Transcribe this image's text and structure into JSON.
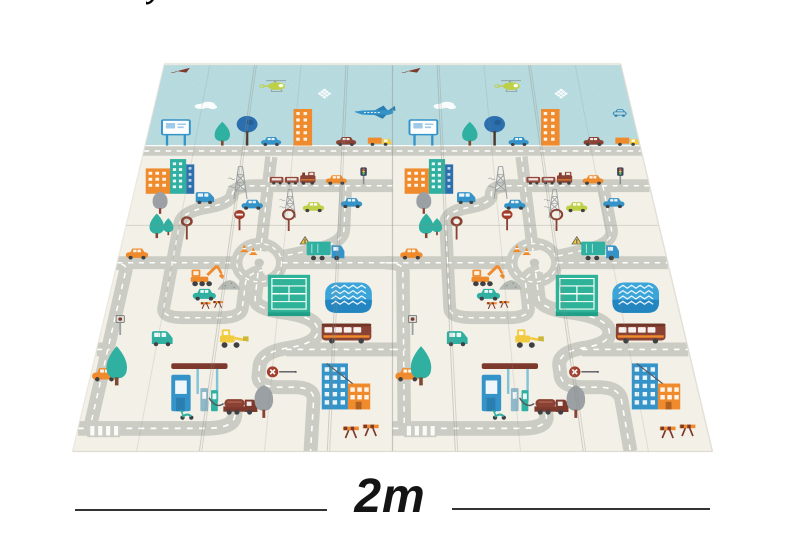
{
  "image_type": "product-photo of foldable baby play mat with road map print",
  "annotation": {
    "label": "2m",
    "y": 510,
    "lines": [
      [
        75,
        327
      ],
      [
        452,
        710
      ]
    ]
  },
  "cropped_text_fragment": "y",
  "palette": {
    "cream": "#f3f0e7",
    "skyBlue": "#b6dade",
    "roadGray": "#cbccc3",
    "roadDash": "#ffffff",
    "teal": "#2fb0a0",
    "courtGreen": "#2eb398",
    "courtDark": "#1f9e88",
    "blue": "#3493c8",
    "blueDark": "#2a7fb0",
    "pondBlue": "#3ba4d9",
    "pondDark": "#2386c0",
    "navy": "#2b6fae",
    "maroon": "#8a4234",
    "darkRed": "#7d392c",
    "orange": "#ef8b2d",
    "yellow": "#f2ca3f",
    "yellowGreen": "#bed048",
    "gray": "#9aa0a3",
    "slate": "#55565a",
    "wheel": "#3f4043",
    "trunk": "#7c4a33",
    "black": "#1b1b1b",
    "edge": "#e4e1d8",
    "crease": "#8f9089",
    "windowWhite": "#ffffff"
  },
  "mat": {
    "projection": {
      "P": 2339,
      "sin": 0.866,
      "flatW": 640,
      "flatH": 1087,
      "centerX": 392.5,
      "bottomY": 451.5
    },
    "skyBand": {
      "top": 0,
      "bottom": 295
    },
    "skyRoad": {
      "top": 295,
      "bottom": 333
    },
    "halves": [
      0,
      320
    ],
    "creases": [
      {
        "x": 64,
        "w": "light"
      },
      {
        "x": 128,
        "w": "strong"
      },
      {
        "x": 192,
        "w": "light"
      },
      {
        "x": 256,
        "w": "strong"
      },
      {
        "x": 320,
        "w": "seam"
      },
      {
        "x": 384,
        "w": "strong"
      },
      {
        "x": 448,
        "w": "light"
      },
      {
        "x": 512,
        "w": "strong"
      },
      {
        "x": 576,
        "w": "light"
      }
    ],
    "hCrease": 544
  },
  "roads": {
    "width": 15,
    "paths": [
      [
        "M",
        165,
        333,
        "V",
        616
      ],
      [
        "M",
        320,
        425,
        "H",
        150,
        "Q",
        122,
        425,
        122,
        452,
        "Q",
        122,
        478,
        96,
        490,
        "Q",
        64,
        502,
        64,
        540,
        "V",
        766,
        "Q",
        64,
        790,
        88,
        790,
        "H",
        128,
        "Q",
        152,
        790,
        152,
        766,
        "V",
        702,
        "Q",
        152,
        678,
        170,
        668
      ],
      [
        "M",
        262,
        425,
        "V",
        555,
        "Q",
        262,
        588,
        238,
        606,
        "Q",
        214,
        620,
        191,
        631
      ],
      [
        "M",
        0,
        648,
        "H",
        138
      ],
      [
        "M",
        192,
        648,
        "H",
        320
      ],
      [
        "M",
        165,
        675,
        "V",
        740,
        "Q",
        165,
        766,
        195,
        776,
        "Q",
        238,
        788,
        238,
        822,
        "Q",
        238,
        852,
        208,
        862,
        "Q",
        178,
        872,
        178,
        905,
        "V",
        926,
        "Q",
        178,
        952,
        202,
        952,
        "H",
        216,
        "Q",
        238,
        952,
        238,
        980,
        "V",
        1087
      ],
      [
        "M",
        0,
        1040,
        "H",
        130,
        "Q",
        158,
        1040,
        158,
        1014,
        "V",
        988
      ],
      [
        "M",
        -8,
        648,
        "Q",
        12,
        648,
        12,
        669,
        "V",
        1040
      ],
      [
        "M",
        205,
        866,
        "H",
        320
      ],
      [
        "M",
        0,
        866,
        "H",
        14
      ]
    ],
    "roundabout": {
      "x": 165,
      "y": 648,
      "r": 26
    }
  },
  "objects": [
    {
      "t": "kite",
      "x": 30,
      "y": 42
    },
    {
      "t": "heli",
      "x": 160,
      "y": 108
    },
    {
      "t": "cloud",
      "x": 70,
      "y": 170
    },
    {
      "t": "cloudDiamond",
      "x": 228,
      "y": 136
    },
    {
      "t": "plane",
      "x": 298,
      "y": 196,
      "half": 0
    },
    {
      "t": "carOutline",
      "x": 302,
      "y": 198,
      "half": 1
    },
    {
      "t": "billboard",
      "x": 40,
      "y": 296
    },
    {
      "t": "treeTeal",
      "x": 100,
      "y": 296,
      "s": 1.15
    },
    {
      "t": "treeBlue",
      "x": 132,
      "y": 296
    },
    {
      "t": "sedan",
      "x": 163,
      "y": 296,
      "c": "blue"
    },
    {
      "t": "building",
      "x": 204,
      "y": 296
    },
    {
      "t": "sedan",
      "x": 260,
      "y": 296,
      "c": "maroon"
    },
    {
      "t": "truckSmall",
      "x": 303,
      "y": 296
    },
    {
      "t": "cityblock",
      "x": 45,
      "y": 450
    },
    {
      "t": "pylon",
      "x": 133,
      "y": 466
    },
    {
      "t": "train",
      "x": 196,
      "y": 421
    },
    {
      "t": "sedan",
      "x": 250,
      "y": 421,
      "c": "orange"
    },
    {
      "t": "trafficLight",
      "x": 284,
      "y": 421
    },
    {
      "t": "treeGray",
      "x": 38,
      "y": 510
    },
    {
      "t": "van",
      "x": 90,
      "y": 480,
      "c": "blue"
    },
    {
      "t": "sedan",
      "x": 149,
      "y": 497,
      "c": "blue"
    },
    {
      "t": "pylon",
      "x": 196,
      "y": 522,
      "s": 0.85
    },
    {
      "t": "sedan",
      "x": 224,
      "y": 504,
      "c": "yellowGreen"
    },
    {
      "t": "sedan",
      "x": 270,
      "y": 492,
      "c": "blue"
    },
    {
      "t": "treeTeal",
      "x": 40,
      "y": 580
    },
    {
      "t": "treeTeal",
      "x": 53,
      "y": 572,
      "s": 0.7
    },
    {
      "t": "signBall",
      "x": 76,
      "y": 584
    },
    {
      "t": "signNoEntry",
      "x": 137,
      "y": 558
    },
    {
      "t": "signRound",
      "x": 196,
      "y": 560
    },
    {
      "t": "cone",
      "x": 146,
      "y": 618
    },
    {
      "t": "cone",
      "x": 157,
      "y": 626
    },
    {
      "t": "signWarn",
      "x": 217,
      "y": 607
    },
    {
      "t": "sedan",
      "x": 22,
      "y": 638,
      "c": "orange"
    },
    {
      "t": "truckBox",
      "x": 243,
      "y": 640
    },
    {
      "t": "excavator",
      "x": 104,
      "y": 710
    },
    {
      "t": "mound",
      "x": 134,
      "y": 719
    },
    {
      "t": "court",
      "x": 205,
      "y": 786
    },
    {
      "t": "pond",
      "x": 271,
      "y": 778
    },
    {
      "t": "barrier",
      "x": 118,
      "y": 768,
      "s": 0.7
    },
    {
      "t": "sedan",
      "x": 108,
      "y": 746,
      "c": "teal"
    },
    {
      "t": "signPole",
      "x": 22,
      "y": 832
    },
    {
      "t": "bus",
      "x": 270,
      "y": 850
    },
    {
      "t": "van",
      "x": 70,
      "y": 858,
      "c": "teal"
    },
    {
      "t": "loader",
      "x": 145,
      "y": 862
    },
    {
      "t": "treeTeal",
      "x": 30,
      "y": 948,
      "s": 1.25
    },
    {
      "t": "sedan",
      "x": 16,
      "y": 938,
      "c": "orange"
    },
    {
      "t": "gas",
      "x": 124,
      "y": 1004
    },
    {
      "t": "truckTank",
      "x": 162,
      "y": 1010
    },
    {
      "t": "scooter",
      "x": 110,
      "y": 1022
    },
    {
      "t": "treeGray",
      "x": 188,
      "y": 1018,
      "s": 1.05
    },
    {
      "t": "signStick",
      "x": 200,
      "y": 928
    },
    {
      "t": "bldgPair",
      "x": 272,
      "y": 1000
    },
    {
      "t": "crosswalk",
      "x": 28,
      "y": 1058
    },
    {
      "t": "barrier",
      "x": 288,
      "y": 1060
    }
  ]
}
